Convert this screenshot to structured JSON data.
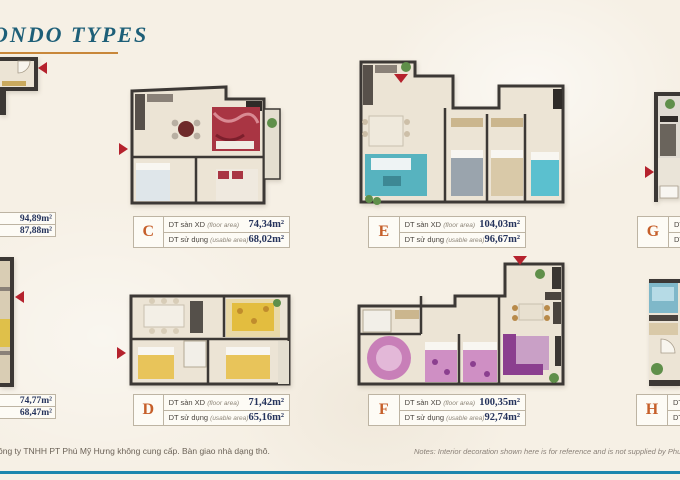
{
  "page": {
    "title": "ONDO TYPES",
    "footer_left": "ông ty TNHH PT Phú Mỹ Hưng không cung cấp. Bàn giao nhà dạng thô.",
    "footer_right": "Notes: Interior decoration shown here is for reference and is not supplied by Phu My Hung Develo"
  },
  "area_labels": {
    "floor": "DT sàn XD",
    "floor_sub": "(floor area)",
    "usable": "DT sử dụng",
    "usable_sub": "(usable area)"
  },
  "units": {
    "left_top": {
      "floor_area": "94,89m²",
      "usable_area": "87,88m²"
    },
    "c": {
      "letter": "C",
      "floor_area": "74,34m²",
      "usable_area": "68,02m²"
    },
    "e": {
      "letter": "E",
      "floor_area": "104,03m²",
      "usable_area": "96,67m²"
    },
    "g": {
      "letter": "G"
    },
    "left_bottom": {
      "floor_area": "74,77m²",
      "usable_area": "68,47m²"
    },
    "d": {
      "letter": "D",
      "floor_area": "71,42m²",
      "usable_area": "65,16m²"
    },
    "f": {
      "letter": "F",
      "floor_area": "100,35m²",
      "usable_area": "92,74m²"
    },
    "h": {
      "letter": "H"
    }
  },
  "colors": {
    "bg": "#f6f0e5",
    "title": "#1e5f78",
    "underline": "#c8873a",
    "letter": "#c65f2a",
    "value": "#25335c",
    "label": "#4a453f",
    "box-border": "#bdb4a3",
    "arrow": "#b5222d",
    "wall": "#3c3835",
    "floor": "#ece4d5",
    "footer-line": "#1d86ad",
    "footer-text": "#6b6257"
  }
}
